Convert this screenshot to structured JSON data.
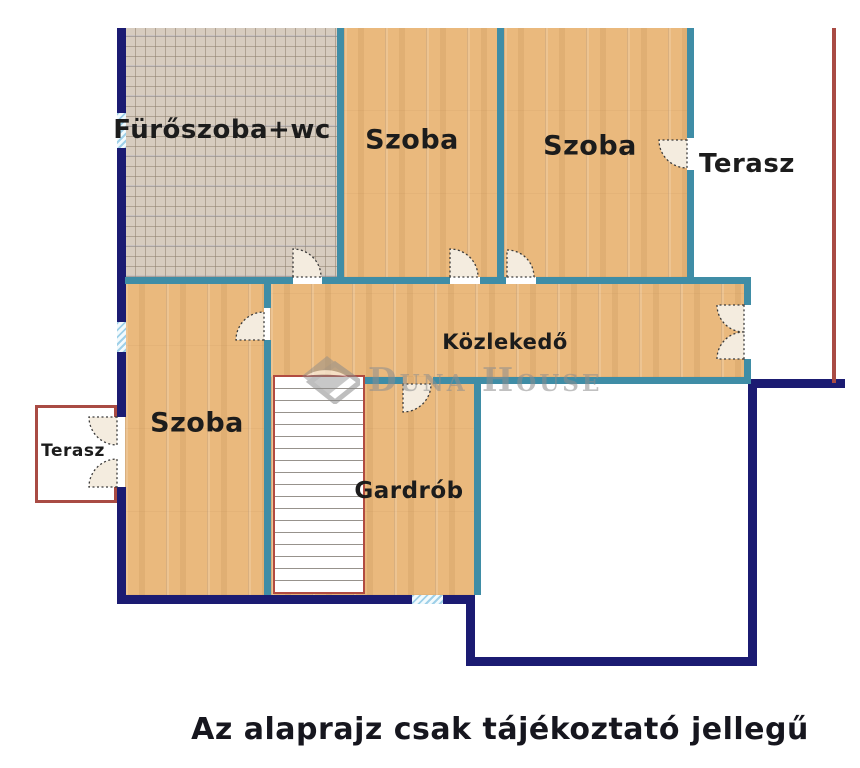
{
  "plan": {
    "caption": "Az alaprajz csak tájékoztató jellegű",
    "watermark": "Duna House",
    "rooms": [
      {
        "key": "bathroom",
        "label": "Fürőszoba+wc",
        "floor": "tile"
      },
      {
        "key": "room-top-left",
        "label": "Szoba",
        "floor": "wood"
      },
      {
        "key": "room-top-right",
        "label": "Szoba",
        "floor": "wood"
      },
      {
        "key": "terrace-top-right",
        "label": "Terasz",
        "floor": "open"
      },
      {
        "key": "hallway",
        "label": "Közlekedő",
        "floor": "wood"
      },
      {
        "key": "room-left",
        "label": "Szoba",
        "floor": "wood"
      },
      {
        "key": "terrace-left",
        "label": "Terasz",
        "floor": "open"
      },
      {
        "key": "wardrobe",
        "label": "Gardrób",
        "floor": "wood"
      }
    ],
    "features": [
      "stairs",
      "window-markers",
      "door-swings"
    ],
    "colors": {
      "exterior_wall": "#1b1b72",
      "interior_wall": "#3f8da6",
      "terrace_border": "#a94b44",
      "wood_floor": "#eab97d",
      "tile_floor": "#d7ccbf",
      "window_glass": "#9fd0e8",
      "door_leaf": "#f4ecdf",
      "label_text": "#1c1c1c",
      "caption_text": "#16161e",
      "watermark_gray": "#8e8e8e"
    }
  }
}
